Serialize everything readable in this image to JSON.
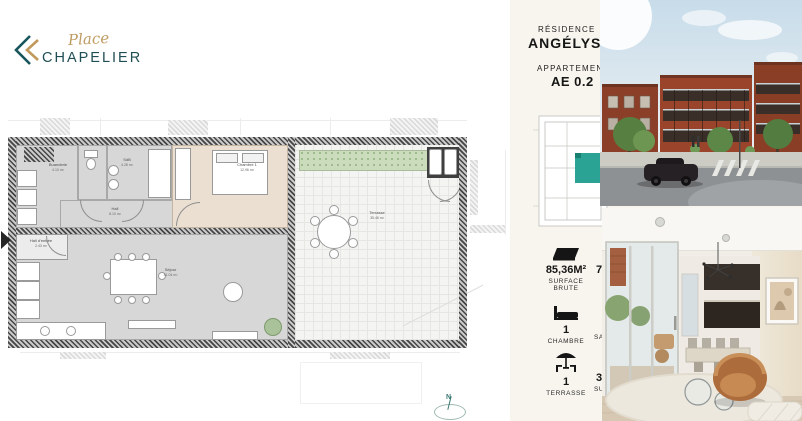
{
  "brand": {
    "script": "Place",
    "name": "CHAPELIER",
    "colors": {
      "teal": "#1f4e54",
      "gold": "#bf9b62"
    }
  },
  "panel": {
    "residence_label": "RÉSIDENCE",
    "residence_name": "ANGÉLYS",
    "apartment_label": "APPARTEMENT",
    "apartment_code": "AE 0.2",
    "accent_color": "#2ba394",
    "stats": [
      {
        "icon": "area-icon",
        "value": "85,36M²",
        "label1": "SURFACE",
        "label2": "BRUTE"
      },
      {
        "icon": "bed-icon",
        "value": "1",
        "label1": "CHAMBRE"
      },
      {
        "icon": "parasol-icon",
        "value": "1",
        "label1": "TERRASSE"
      }
    ],
    "col2_fragments": [
      "7",
      "SA",
      "3",
      "SU"
    ]
  },
  "floorplan": {
    "rooms": [
      {
        "name": "Buanderie",
        "area": "4.10 m²"
      },
      {
        "name": "SdB",
        "area": "4.28 m²"
      },
      {
        "name": "Hall",
        "area": "8.10 m²"
      },
      {
        "name": "Chambre 1",
        "area": "12.96 m²"
      },
      {
        "name": "Hall d'entrée",
        "area": "2.43 m²"
      },
      {
        "name": "Séjour",
        "area": "41.04 m²"
      },
      {
        "name": "Terrasse",
        "area": "35.46 m²"
      }
    ],
    "compass": "N"
  }
}
